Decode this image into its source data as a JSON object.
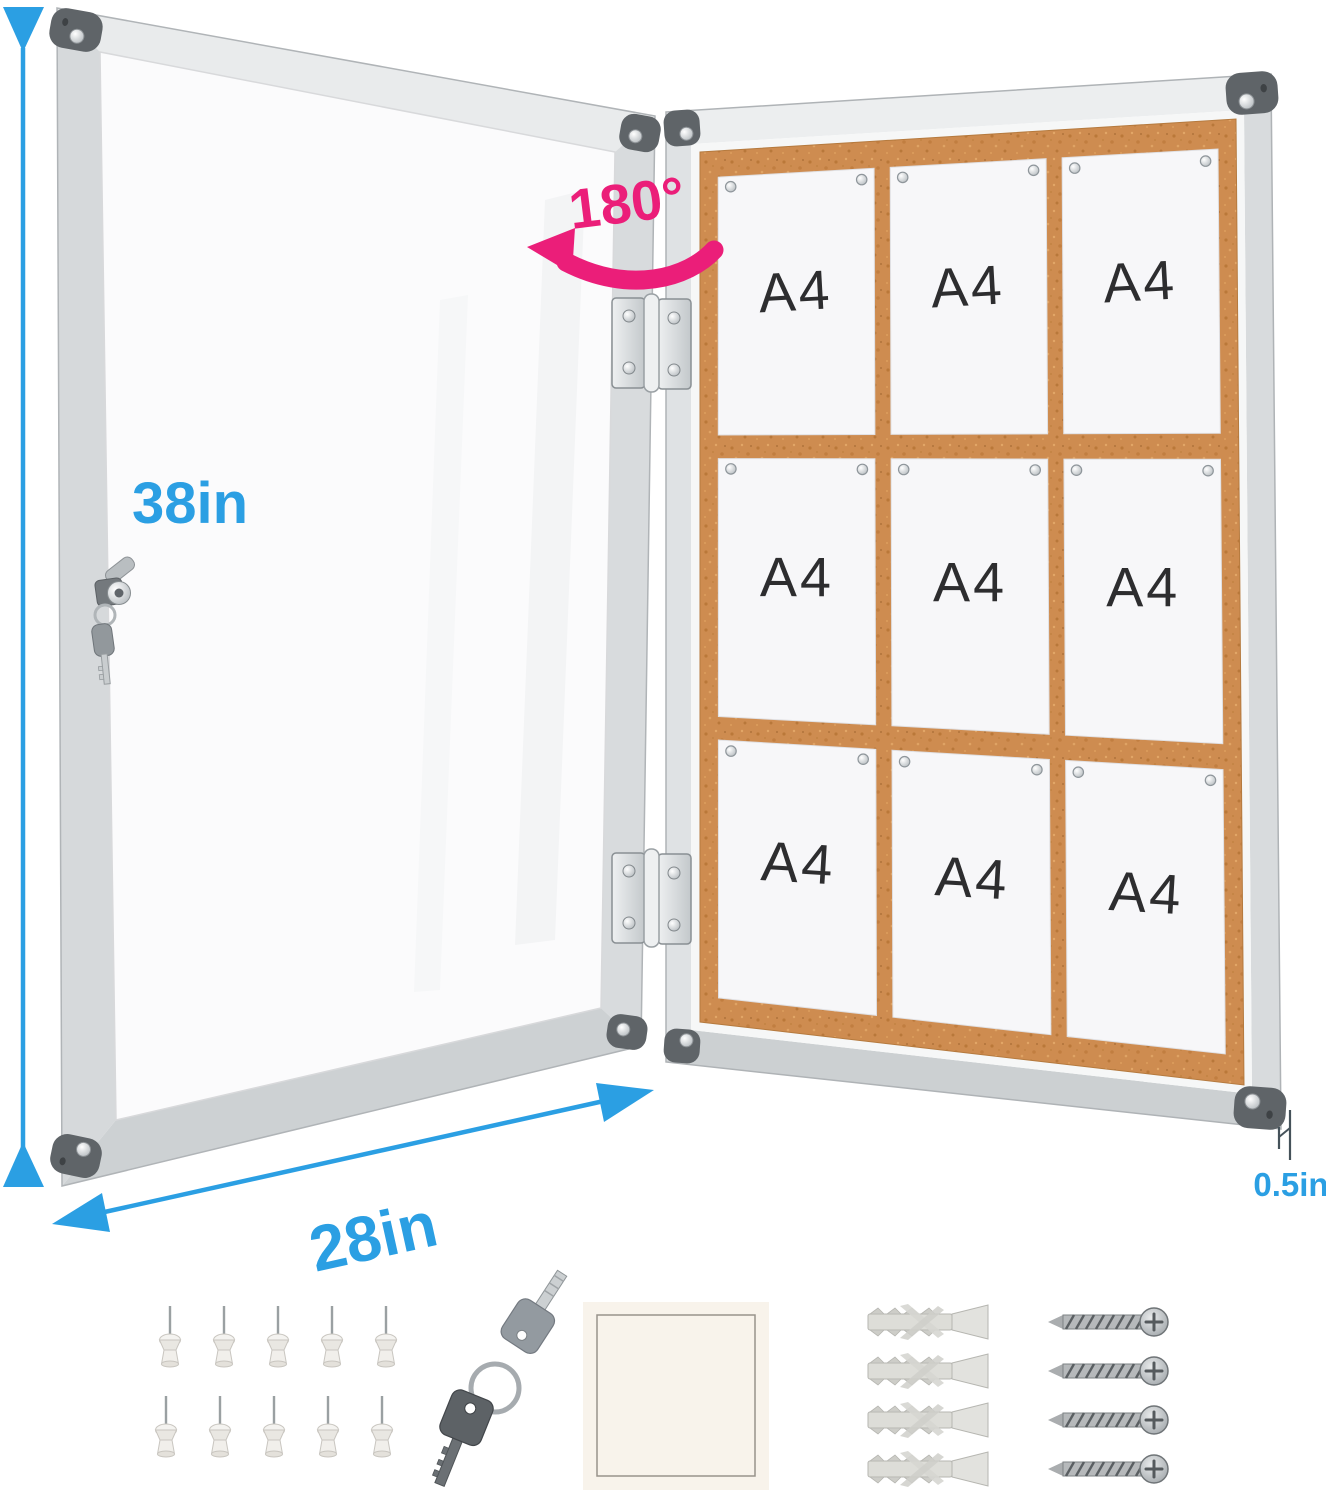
{
  "dimension_labels": {
    "height": "38in",
    "width": "28in",
    "depth": "0.5in"
  },
  "door_swing_label": "180°",
  "board": {
    "paper_label": "A4",
    "paper_rows": 3,
    "paper_cols": 3
  },
  "accessories": {
    "push_pins": 10,
    "push_pins_per_row": 5,
    "keys": 2,
    "adhesive_squares": 1,
    "wall_anchors": 4,
    "screws": 4
  },
  "colors": {
    "dimension_blue": "#2B9FE3",
    "swing_pink": "#EB1E79",
    "cork": "#CE8C50",
    "frame_silver": "#D5D9DB",
    "corner_cap": "#5F6468",
    "paper_white": "#F7F7F9",
    "a4_text": "#2D2D2F"
  }
}
